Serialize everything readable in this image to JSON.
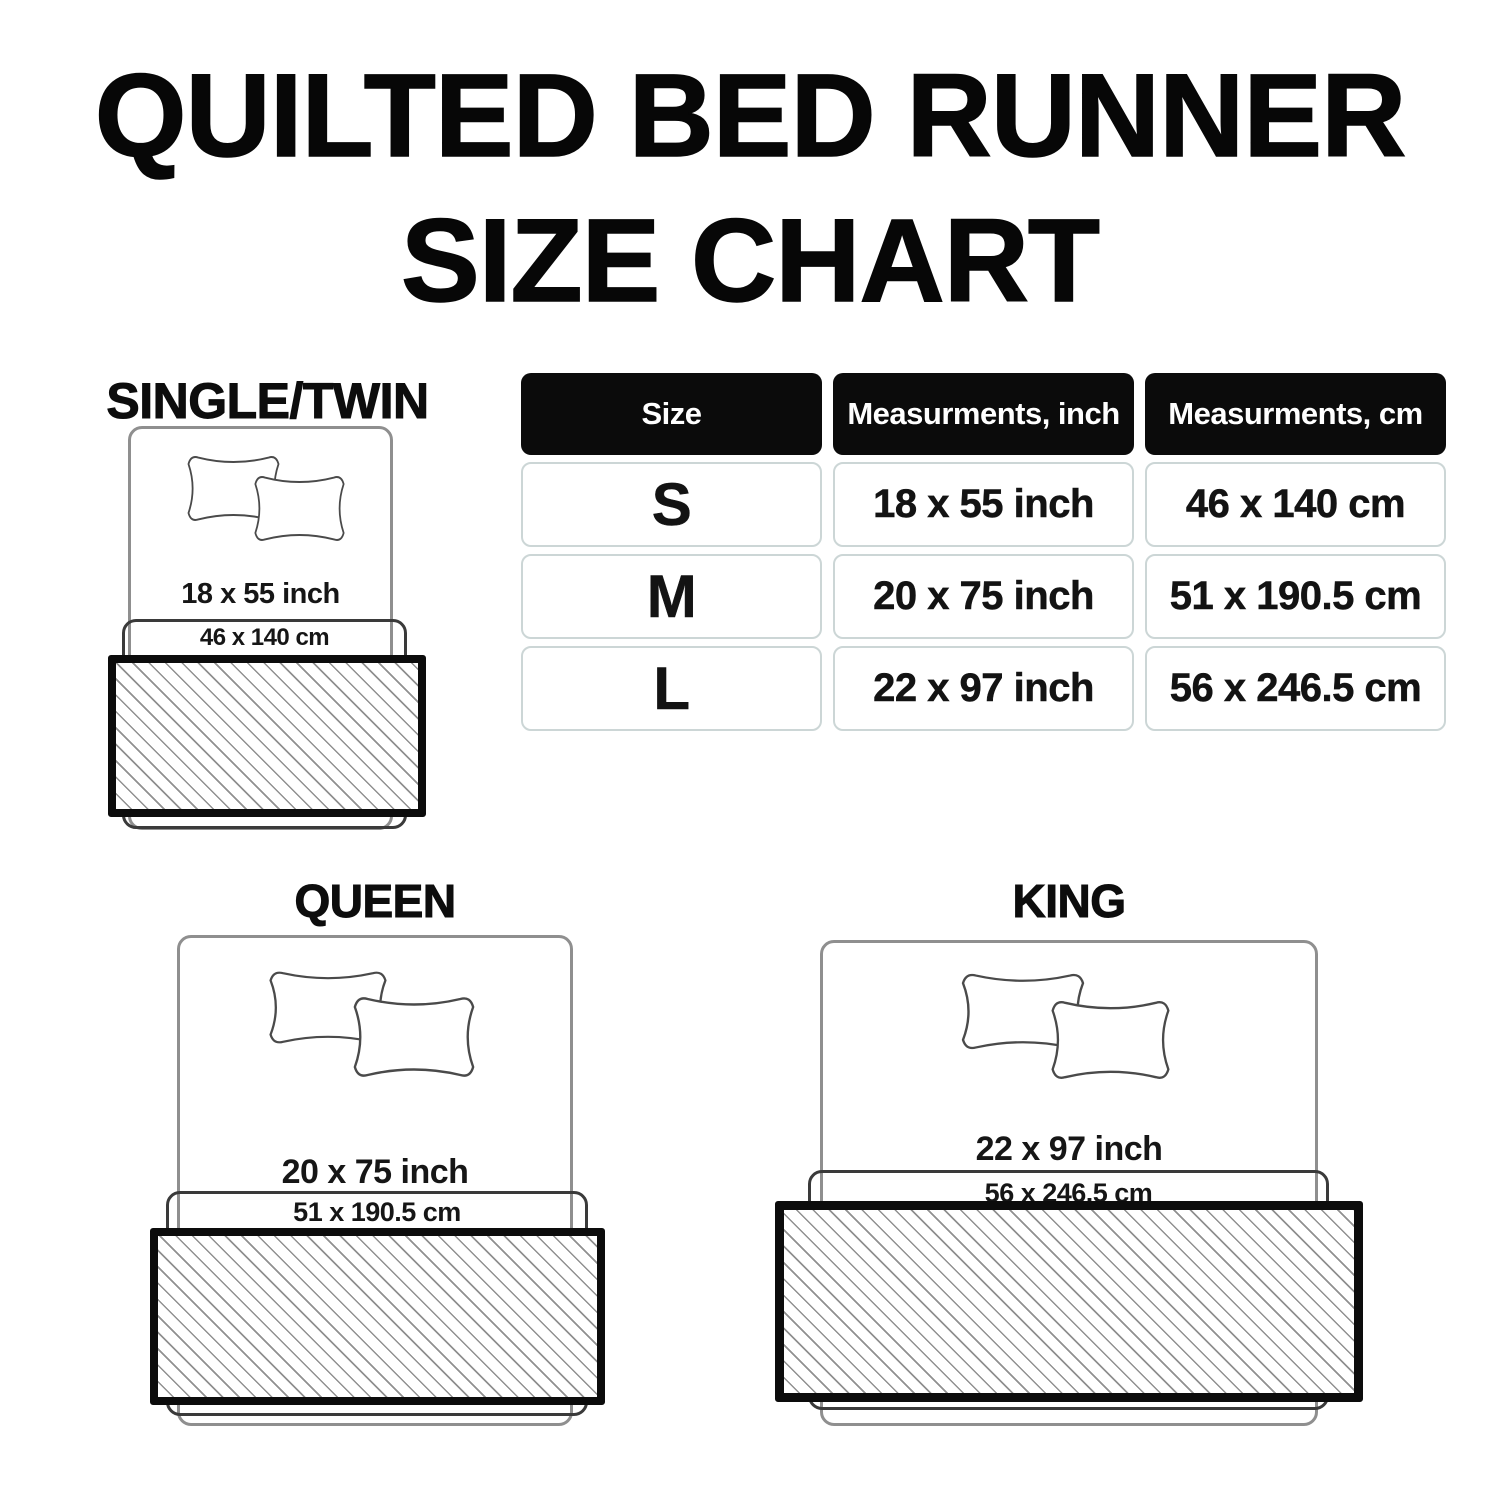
{
  "title": {
    "line1": "QUILTED BED RUNNER",
    "line2": "SIZE CHART"
  },
  "table": {
    "headers": [
      "Size",
      "Measurments, inch",
      "Measurments, cm"
    ],
    "rows": [
      {
        "size": "S",
        "inch": "18 x 55 inch",
        "cm": "46 x 140 cm"
      },
      {
        "size": "M",
        "inch": "20 x 75 inch",
        "cm": "51 x 190.5 cm"
      },
      {
        "size": "L",
        "inch": "22 x 97 inch",
        "cm": "56 x 246.5 cm"
      }
    ]
  },
  "diagrams": {
    "single": {
      "label": "SINGLE/TWIN",
      "inch": "18 x 55 inch",
      "cm": "46 x 140 cm"
    },
    "queen": {
      "label": "QUEEN",
      "inch": "20 x 75 inch",
      "cm": "51 x 190.5 cm"
    },
    "king": {
      "label": "KING",
      "inch": "22 x 97 inch",
      "cm": "56 x 246.5 cm"
    }
  },
  "colors": {
    "text": "#131313",
    "header_bg": "#0b0b0b",
    "header_text": "#ffffff",
    "cell_border": "#ccd6d6",
    "bed_outline": "#8f8f8f",
    "runner_outline": "#3a3a3a",
    "runner_border": "#0c0c0c",
    "hatch_line": "#909090"
  }
}
